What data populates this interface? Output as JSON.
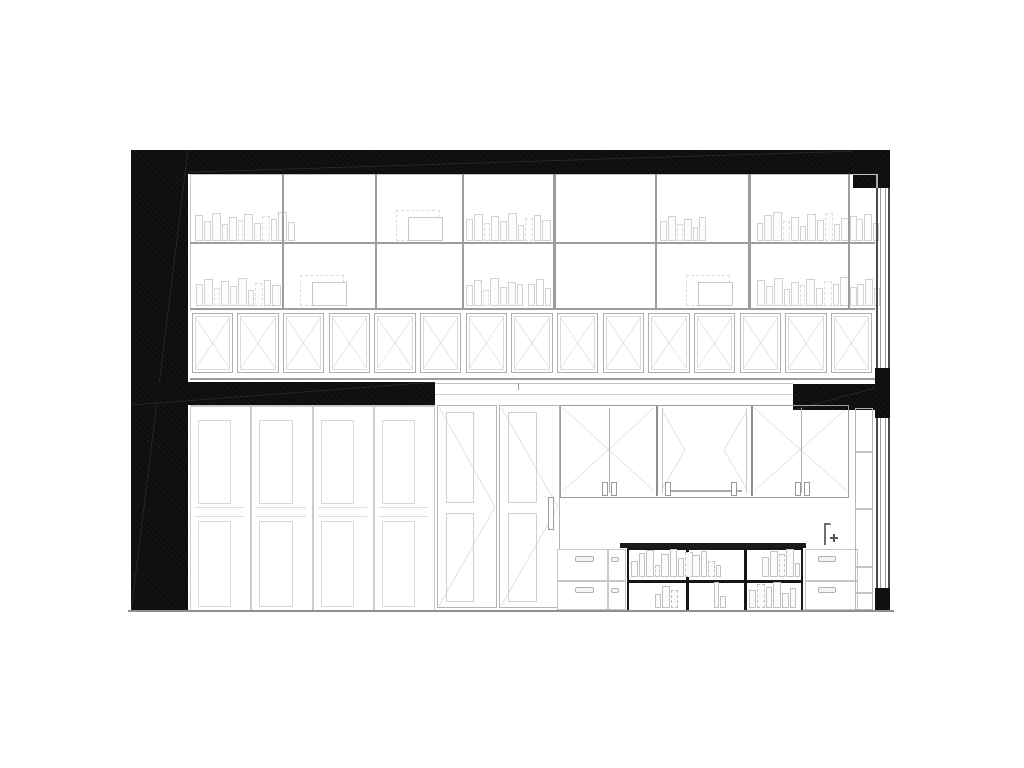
{
  "drawing": {
    "kind": "architectural-section-elevation",
    "colors": {
      "poche": "#0e0e0e",
      "paper": "#ffffff",
      "line_faint": "#d8d8d8",
      "line_light": "#c6c6c6",
      "line_mid": "#9d9d9d",
      "line_dark": "#4a4a4a",
      "frame_dark": "#161616",
      "ground": "#8f8f8f"
    },
    "bookshelf": {
      "left": 190,
      "top": 174,
      "right": 875,
      "shelf_lines_y": [
        242,
        308
      ],
      "dividers_x": [
        282,
        375,
        462,
        553,
        655,
        748,
        848
      ]
    },
    "x_panel_row": {
      "x": 190,
      "y": 311,
      "w": 685,
      "h": 66,
      "count": 15,
      "bottom_line_y": 378
    },
    "book_patterns": {
      "pA": [
        [
          6,
          24
        ],
        [
          5,
          18
        ],
        [
          7,
          26
        ],
        [
          4,
          15
        ],
        [
          6,
          22
        ],
        [
          3,
          19,
          1
        ],
        [
          7,
          25
        ],
        [
          5,
          16
        ],
        [
          6,
          23,
          1
        ],
        [
          4,
          20
        ],
        [
          7,
          27
        ],
        [
          5,
          17
        ]
      ],
      "pB": [
        [
          5,
          20
        ],
        [
          7,
          25
        ],
        [
          4,
          16,
          1
        ],
        [
          6,
          23
        ],
        [
          5,
          18
        ],
        [
          7,
          26
        ],
        [
          4,
          14
        ],
        [
          6,
          21,
          1
        ],
        [
          5,
          24
        ],
        [
          7,
          19
        ]
      ],
      "pC": [
        [
          4,
          16
        ],
        [
          6,
          24
        ],
        [
          7,
          27
        ],
        [
          5,
          18,
          1
        ],
        [
          6,
          22
        ],
        [
          4,
          13
        ],
        [
          7,
          25
        ],
        [
          5,
          19
        ],
        [
          6,
          26,
          1
        ],
        [
          4,
          15
        ],
        [
          6,
          21
        ],
        [
          5,
          23
        ],
        [
          3,
          17
        ]
      ],
      "pD": [
        [
          5,
          19
        ],
        [
          6,
          24
        ],
        [
          4,
          14,
          1
        ],
        [
          7,
          26
        ],
        [
          5,
          17
        ],
        [
          6,
          22
        ],
        [
          4,
          20
        ]
      ],
      "pS": [
        [
          5,
          18
        ],
        [
          6,
          23
        ],
        [
          4,
          15,
          1
        ],
        [
          6,
          20
        ],
        [
          3,
          12
        ],
        [
          5,
          22
        ]
      ],
      "pN": [
        [
          5,
          20
        ],
        [
          6,
          25
        ],
        [
          4,
          16
        ]
      ],
      "cA": [
        [
          5,
          14
        ],
        [
          4,
          22
        ],
        [
          6,
          25
        ],
        [
          3,
          10,
          1
        ],
        [
          6,
          21
        ],
        [
          5,
          26
        ],
        [
          4,
          17
        ],
        [
          6,
          23,
          1
        ],
        [
          3,
          12
        ]
      ],
      "cB": [
        [
          6,
          20
        ],
        [
          4,
          24
        ],
        [
          5,
          14,
          1
        ],
        [
          3,
          10
        ]
      ],
      "cC": [
        [
          5,
          18
        ],
        [
          6,
          24
        ],
        [
          4,
          21,
          1
        ],
        [
          6,
          26
        ],
        [
          3,
          12
        ]
      ],
      "cD": [
        [
          4,
          12
        ],
        [
          6,
          20
        ],
        [
          5,
          16,
          1
        ]
      ],
      "cE": [
        [
          3,
          24
        ],
        [
          4,
          10
        ]
      ],
      "cF": [
        [
          5,
          16
        ],
        [
          6,
          22,
          1
        ],
        [
          4,
          19
        ],
        [
          6,
          24
        ],
        [
          5,
          13
        ],
        [
          4,
          18
        ]
      ]
    },
    "upper_book_groups": [
      {
        "x": 195,
        "bottom": 241,
        "pattern": "pA"
      },
      {
        "x": 466,
        "bottom": 241,
        "pattern": "pB"
      },
      {
        "x": 660,
        "bottom": 241,
        "pattern": "pS"
      },
      {
        "x": 757,
        "bottom": 241,
        "pattern": "pC"
      },
      {
        "x": 856,
        "bottom": 241,
        "pattern": "pN"
      },
      {
        "x": 196,
        "bottom": 306,
        "pattern": "pB"
      },
      {
        "x": 466,
        "bottom": 306,
        "pattern": "pD"
      },
      {
        "x": 528,
        "bottom": 306,
        "pattern": "pN"
      },
      {
        "x": 757,
        "bottom": 306,
        "pattern": "pA"
      },
      {
        "x": 857,
        "bottom": 306,
        "pattern": "pN"
      }
    ],
    "upper_frame_groups": [
      {
        "x": 396,
        "bottom": 241
      },
      {
        "x": 300,
        "bottom": 306
      },
      {
        "x": 686,
        "bottom": 306
      }
    ],
    "wardrobe": {
      "x": 190,
      "y": 405,
      "w": 245,
      "h": 205,
      "door_count": 4
    },
    "tall_doors": {
      "x": 437,
      "y": 405,
      "h": 203,
      "doors": [
        {
          "x": 0,
          "w": 60
        },
        {
          "x": 62,
          "w": 61
        }
      ],
      "handle": {
        "x": 111,
        "y": 92,
        "w": 4,
        "h": 31
      }
    },
    "kitchen_uppers": {
      "x": 560,
      "y": 405,
      "w": 289,
      "h": 93,
      "bays": [
        {
          "type": "xpair",
          "x": 0,
          "w": 96,
          "divider": 48,
          "pulls": [
            41,
            50
          ]
        },
        {
          "type": "open",
          "x": 96,
          "w": 95,
          "rail_y": 84,
          "pulls": [
            8,
            74
          ]
        },
        {
          "type": "xpair",
          "x": 191,
          "w": 98,
          "divider": 49,
          "pulls": [
            43,
            52
          ]
        }
      ]
    },
    "open_shelf": {
      "x": 627,
      "y": 548,
      "w": 176,
      "h": 64,
      "col_dividers": [
        57,
        115
      ],
      "row_divider": 30,
      "books": [
        {
          "x": 631,
          "bottom": 577,
          "pattern": "cA"
        },
        {
          "x": 692,
          "bottom": 577,
          "pattern": "cB"
        },
        {
          "x": 762,
          "bottom": 577,
          "pattern": "cC"
        },
        {
          "x": 655,
          "bottom": 608,
          "pattern": "cD"
        },
        {
          "x": 714,
          "bottom": 608,
          "pattern": "cE"
        },
        {
          "x": 749,
          "bottom": 608,
          "pattern": "cF"
        }
      ]
    },
    "drawer_units": [
      {
        "x": 557,
        "y": 549,
        "w": 69,
        "h": 61,
        "col_divider": 49,
        "row_divider": 30,
        "pulls": [
          {
            "x": 17,
            "y": 6,
            "w": 17,
            "h": 4
          },
          {
            "x": 17,
            "y": 37,
            "w": 17,
            "h": 4
          },
          {
            "x": 53,
            "y": 7,
            "w": 6,
            "h": 3
          },
          {
            "x": 53,
            "y": 38,
            "w": 6,
            "h": 3
          }
        ]
      },
      {
        "x": 805,
        "y": 549,
        "w": 53,
        "h": 61,
        "col_divider": null,
        "row_divider": 30,
        "pulls": [
          {
            "x": 12,
            "y": 6,
            "w": 16,
            "h": 4
          },
          {
            "x": 12,
            "y": 37,
            "w": 16,
            "h": 4
          }
        ]
      }
    ],
    "tall_column_dividers_y": [
      450,
      507,
      565,
      591
    ],
    "windows": {
      "upper": {
        "top": 188,
        "h": 180
      },
      "lower": {
        "top": 418,
        "h": 170
      }
    },
    "slab_edge": {
      "line1_y": 383,
      "line2_y": 394,
      "x": 435,
      "w": 358,
      "tick_x": 518
    },
    "ground": {
      "x": 128,
      "y": 610,
      "w": 766
    }
  }
}
